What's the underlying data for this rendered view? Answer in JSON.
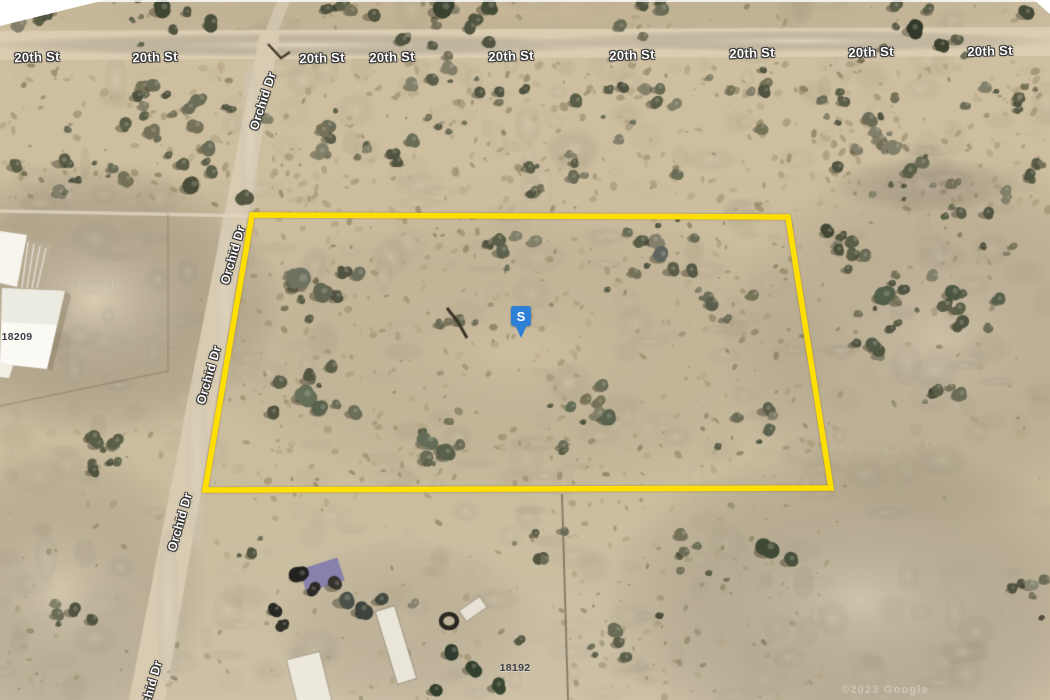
{
  "map_overlay": {
    "street_labels": [
      {
        "text": "20th St",
        "x": 37,
        "y": 57,
        "rot": -2
      },
      {
        "text": "20th St",
        "x": 155,
        "y": 57,
        "rot": -2
      },
      {
        "text": "20th St",
        "x": 322,
        "y": 58,
        "rot": -2
      },
      {
        "text": "20th St",
        "x": 392,
        "y": 57,
        "rot": -2
      },
      {
        "text": "20th St",
        "x": 511,
        "y": 56,
        "rot": -2
      },
      {
        "text": "20th St",
        "x": 632,
        "y": 55,
        "rot": -2
      },
      {
        "text": "20th St",
        "x": 752,
        "y": 53,
        "rot": -2
      },
      {
        "text": "20th St",
        "x": 871,
        "y": 52,
        "rot": -2
      },
      {
        "text": "20th St",
        "x": 990,
        "y": 51,
        "rot": -2
      }
    ],
    "road_labels_vertical": [
      {
        "text": "Orchid Dr",
        "x": 263,
        "y": 101,
        "rot": -72
      },
      {
        "text": "Orchid Dr",
        "x": 233,
        "y": 255,
        "rot": -74
      },
      {
        "text": "Orchid Dr",
        "x": 209,
        "y": 375,
        "rot": -74
      },
      {
        "text": "Orchid Dr",
        "x": 180,
        "y": 522,
        "rot": -74
      },
      {
        "text": "Orchid Dr",
        "x": 150,
        "y": 690,
        "rot": -74
      }
    ],
    "lot_numbers": [
      {
        "text": "18209",
        "x": 17,
        "y": 337
      },
      {
        "text": "18192",
        "x": 515,
        "y": 668
      }
    ],
    "watermarks": [
      {
        "text": "©2023 Google",
        "x": 885,
        "y": 690,
        "opacity": 0.3
      },
      {
        "text": "Google",
        "x": 100,
        "y": 286,
        "opacity": 0.1
      },
      {
        "text": "©2023 Google",
        "x": 858,
        "y": 450,
        "opacity": 0.09
      }
    ],
    "parcel": {
      "stroke_color": "#fedf00",
      "points": "252,215 788,217 831,488 205,490"
    },
    "marker": {
      "label": "S",
      "color": "#2e7fd6",
      "x": 521,
      "y": 316
    }
  }
}
